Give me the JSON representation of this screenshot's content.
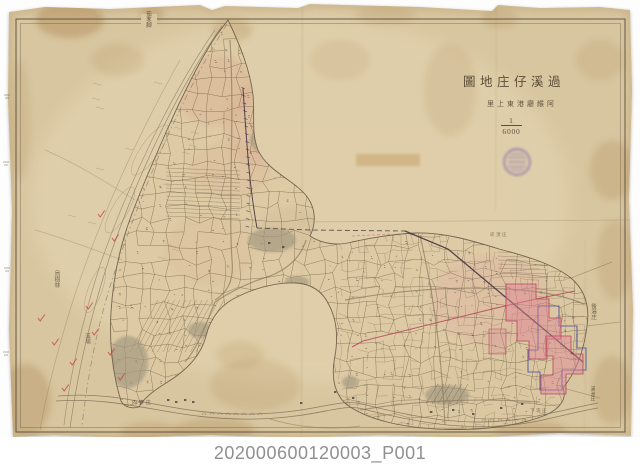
{
  "scan": {
    "catalog_id": "202000600120003_P001",
    "background_color": "#ffffff",
    "paper_color": "#d8c6a0"
  },
  "map": {
    "title": "過溪仔庄地圖",
    "title_display": "圖地庄仔溪過",
    "subtitle": "阿緱廳港東上里",
    "subtitle_display": "里上東港廳緱阿",
    "scale_numerator": "1",
    "scale_denominator": "6000",
    "stamp": {
      "kind": "circular-purple-seal",
      "color": "#7c63ae"
    },
    "annotations": [
      {
        "text": "茄苳脚"
      },
      {
        "text": "烏樹林"
      },
      {
        "text": "溪埔"
      },
      {
        "text": "後湯庄"
      },
      {
        "text": "溪洲庄"
      },
      {
        "text": "內寮庄"
      },
      {
        "text": "崁頂庄"
      },
      {
        "text": "下湳庄"
      }
    ]
  },
  "colors": {
    "paper": "#d8c6a0",
    "paper_light": "#e5d6b2",
    "paper_stain": "#b3905e",
    "ink": "#5f5140",
    "parcel_ink": "#6e5d45",
    "highlight_pink": "#e08296",
    "highlight_red": "#b8475c",
    "survey_red": "#b5485a",
    "boundary_blue": "#4550a5",
    "railway_dark": "#463544",
    "settlement_gray": "#a2977f",
    "stamp_purple": "#7c63ae",
    "caption_gray": "#8e9091"
  }
}
